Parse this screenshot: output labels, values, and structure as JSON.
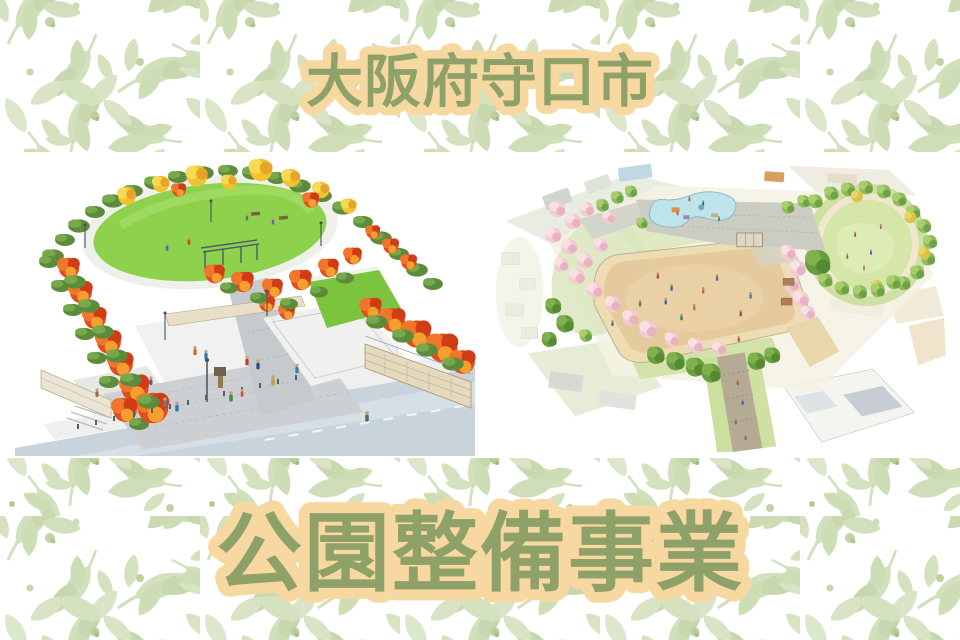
{
  "page": {
    "background": "#ffffff",
    "panel_background": "#ffffff",
    "pattern": {
      "leaf_green": "#cfdeb8",
      "leaf_green_dark": "#c2d4a6",
      "leaf_green_light": "#dde7cc",
      "berry_green": "#bfd1a1"
    }
  },
  "titles": {
    "top": "大阪府守口市",
    "bottom": "公園整備事業",
    "fill_color": "#8a9f66",
    "outline_color": "#f8d8a1"
  },
  "illustrations": {
    "left": {
      "label": "紅葉並木と芝生広場のある公園の完成イメージパース"
    },
    "right": {
      "label": "多目的広場・池・円形芝生広場のある公園の鳥瞰イメージ図"
    }
  }
}
